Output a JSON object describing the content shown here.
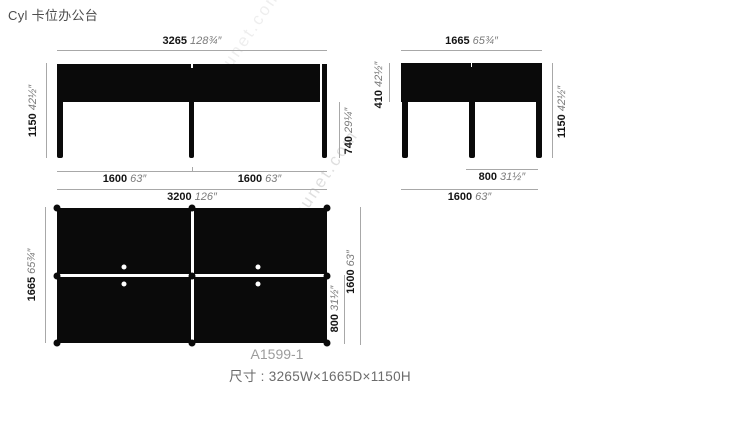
{
  "page": {
    "title": "Cyl 卡位办公台",
    "model_code": "A1599-1",
    "size_label": "尺寸 : 3265W×1665D×1150H",
    "watermark": "snsunet.com"
  },
  "views": {
    "front": {
      "width_top": {
        "mm": "3265",
        "inch": "128¾″"
      },
      "height_left": {
        "mm": "1150",
        "inch": "42½″"
      },
      "desk_height_right": {
        "mm": "740",
        "inch": "29¼″"
      },
      "bay_left": {
        "mm": "1600",
        "inch": "63″"
      },
      "bay_right": {
        "mm": "1600",
        "inch": "63″"
      },
      "width_bottom": {
        "mm": "3200",
        "inch": "126″"
      }
    },
    "side": {
      "depth_top": {
        "mm": "1665",
        "inch": "65¾″"
      },
      "screen_left": {
        "mm": "410",
        "inch": "42½″"
      },
      "height_right": {
        "mm": "1150",
        "inch": "42½″"
      },
      "seat_depth": {
        "mm": "800",
        "inch": "31½″"
      },
      "depth_bottom": {
        "mm": "1600",
        "inch": "63″"
      }
    },
    "plan": {
      "depth_left": {
        "mm": "1665",
        "inch": "65¾″"
      },
      "half_depth_right": {
        "mm": "800",
        "inch": "31½″"
      },
      "depth_right": {
        "mm": "1600",
        "inch": "63″"
      }
    }
  }
}
